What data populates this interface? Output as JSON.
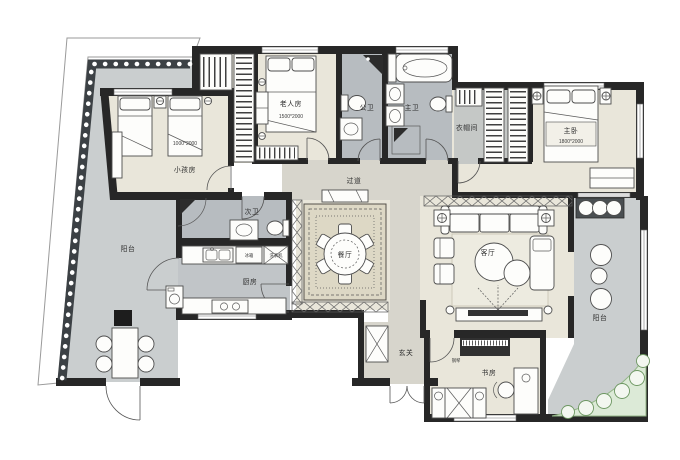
{
  "floorplan": {
    "rooms": {
      "kids_room": "小孩房",
      "elder_room": "老人房",
      "guest_bath": "公卫",
      "master_bath": "主卫",
      "cloakroom": "衣帽间",
      "master_bedroom": "主卧",
      "hallway": "过道",
      "second_bath": "次卫",
      "kitchen": "厨房",
      "dining_room": "餐厅",
      "living_room": "客厅",
      "balcony_left": "阳台",
      "balcony_right": "阳台",
      "entry": "玄关",
      "study": "书房"
    },
    "bed_sizes": {
      "kids_bed": "1000*2000",
      "elder_bed": "1500*2000",
      "master_bed": "1800*2000"
    },
    "appliances": {
      "fridge": "冰箱",
      "washer": "洗衣机",
      "piano": "钢琴"
    },
    "colors": {
      "wall": "#272727",
      "warm_floor": "#e9e6da",
      "wet_floor": "#b7bcc0",
      "balcony_floor": "#cacecf",
      "rug": "#ddd8c5",
      "plant_green": "#6d9762"
    }
  }
}
